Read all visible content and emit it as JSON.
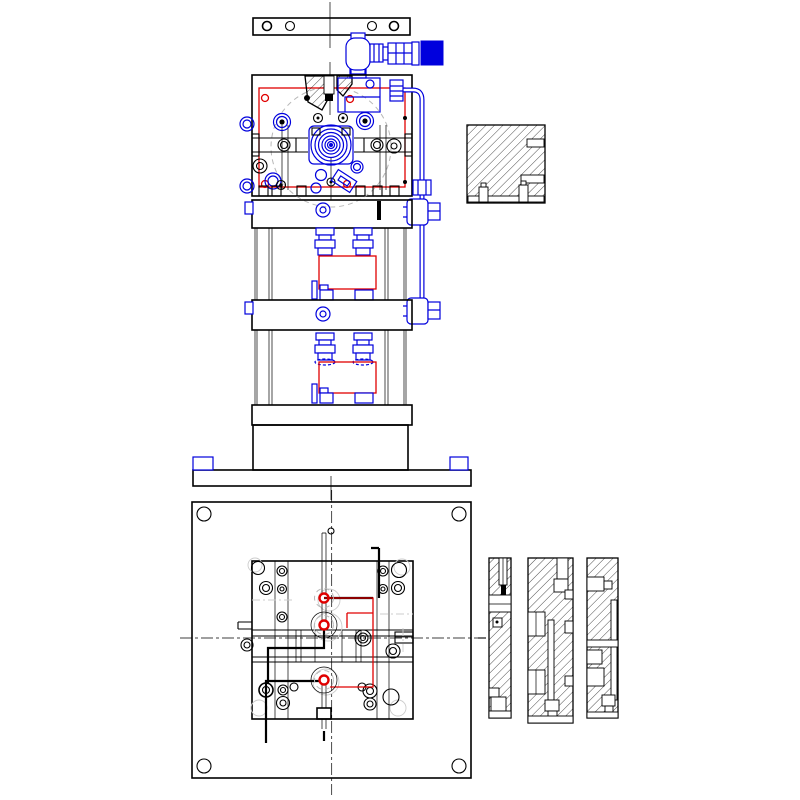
{
  "drawing": {
    "kind": "mechanical-assembly-cad-drawing",
    "views": {
      "front_elevation": "front-elevation-view",
      "plan": "plan-view",
      "detail_block": "hatched-detail-block",
      "section_strips": "section-strip-views",
      "section_strip_count": 3
    },
    "colors": {
      "background": "#ffffff",
      "outline": "#000000",
      "accent_blue": "#0000dd",
      "accent_red": "#e00000",
      "centerline_gray": "#b8b8b8",
      "ghost_gray": "#cccccc"
    }
  }
}
